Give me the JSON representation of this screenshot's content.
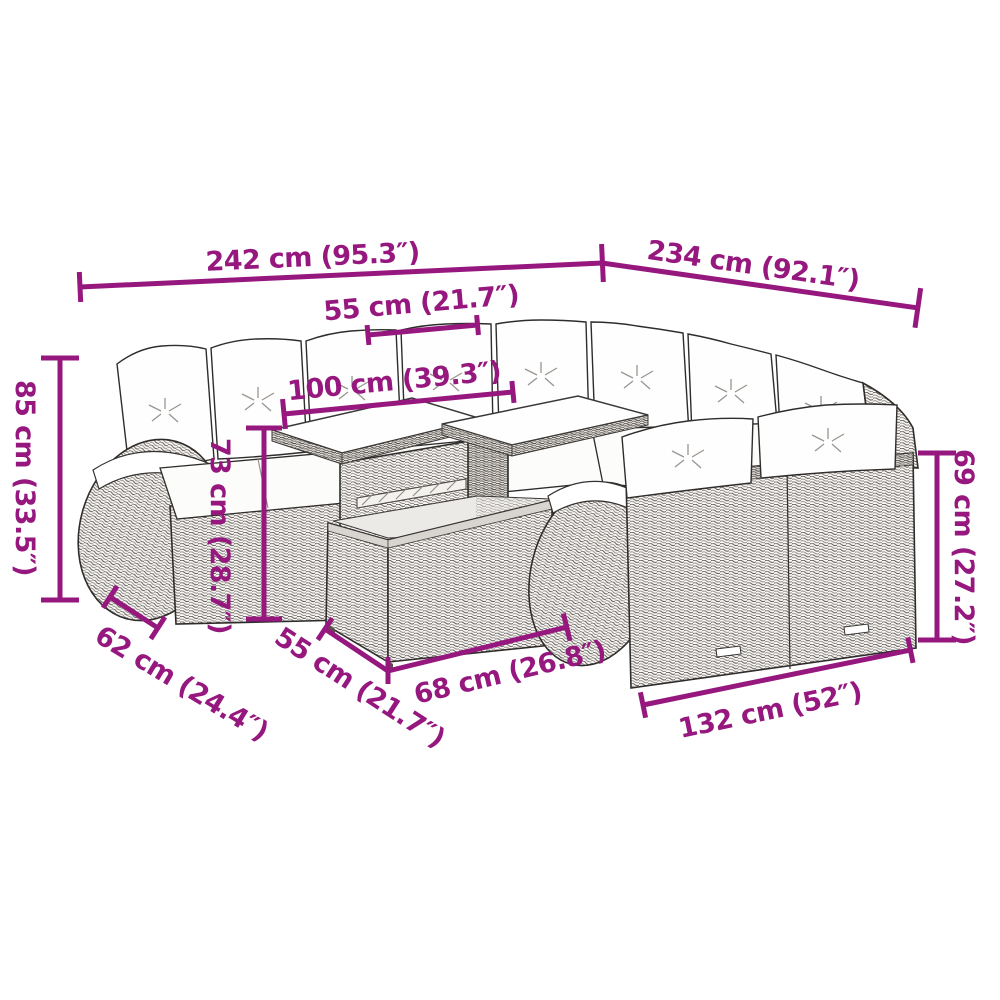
{
  "diagram": {
    "subject": "line drawing of a poly rattan garden lounge set with cushions and a two-panel table",
    "accent_color": "#96187F",
    "line_color": "#2f2d2b",
    "dimensions": [
      {
        "name": "overall-width-left",
        "label": "242 cm (95.3″)",
        "cm": 242,
        "inches": 95.3
      },
      {
        "name": "overall-width-right",
        "label": "234 cm (92.1″)",
        "cm": 234,
        "inches": 92.1
      },
      {
        "name": "table-top-depth",
        "label": "55 cm (21.7″)",
        "cm": 55,
        "inches": 21.7
      },
      {
        "name": "table-top-length",
        "label": "100 cm (39.3″)",
        "cm": 100,
        "inches": 39.3
      },
      {
        "name": "sofa-back-height",
        "label": "85 cm (33.5″)",
        "cm": 85,
        "inches": 33.5
      },
      {
        "name": "table-height",
        "label": "73 cm (28.7″)",
        "cm": 73,
        "inches": 28.7
      },
      {
        "name": "front-sofa-back-height",
        "label": "69 cm (27.2″)",
        "cm": 69,
        "inches": 27.2
      },
      {
        "name": "seat-depth",
        "label": "62 cm (24.4″)",
        "cm": 62,
        "inches": 24.4
      },
      {
        "name": "table-base-depth",
        "label": "55 cm (21.7″)",
        "cm": 55,
        "inches": 21.7
      },
      {
        "name": "table-base-length",
        "label": "68 cm (26.8″)",
        "cm": 68,
        "inches": 26.8
      },
      {
        "name": "front-sofa-length",
        "label": "132 cm (52″)",
        "cm": 132,
        "inches": 52
      }
    ]
  }
}
